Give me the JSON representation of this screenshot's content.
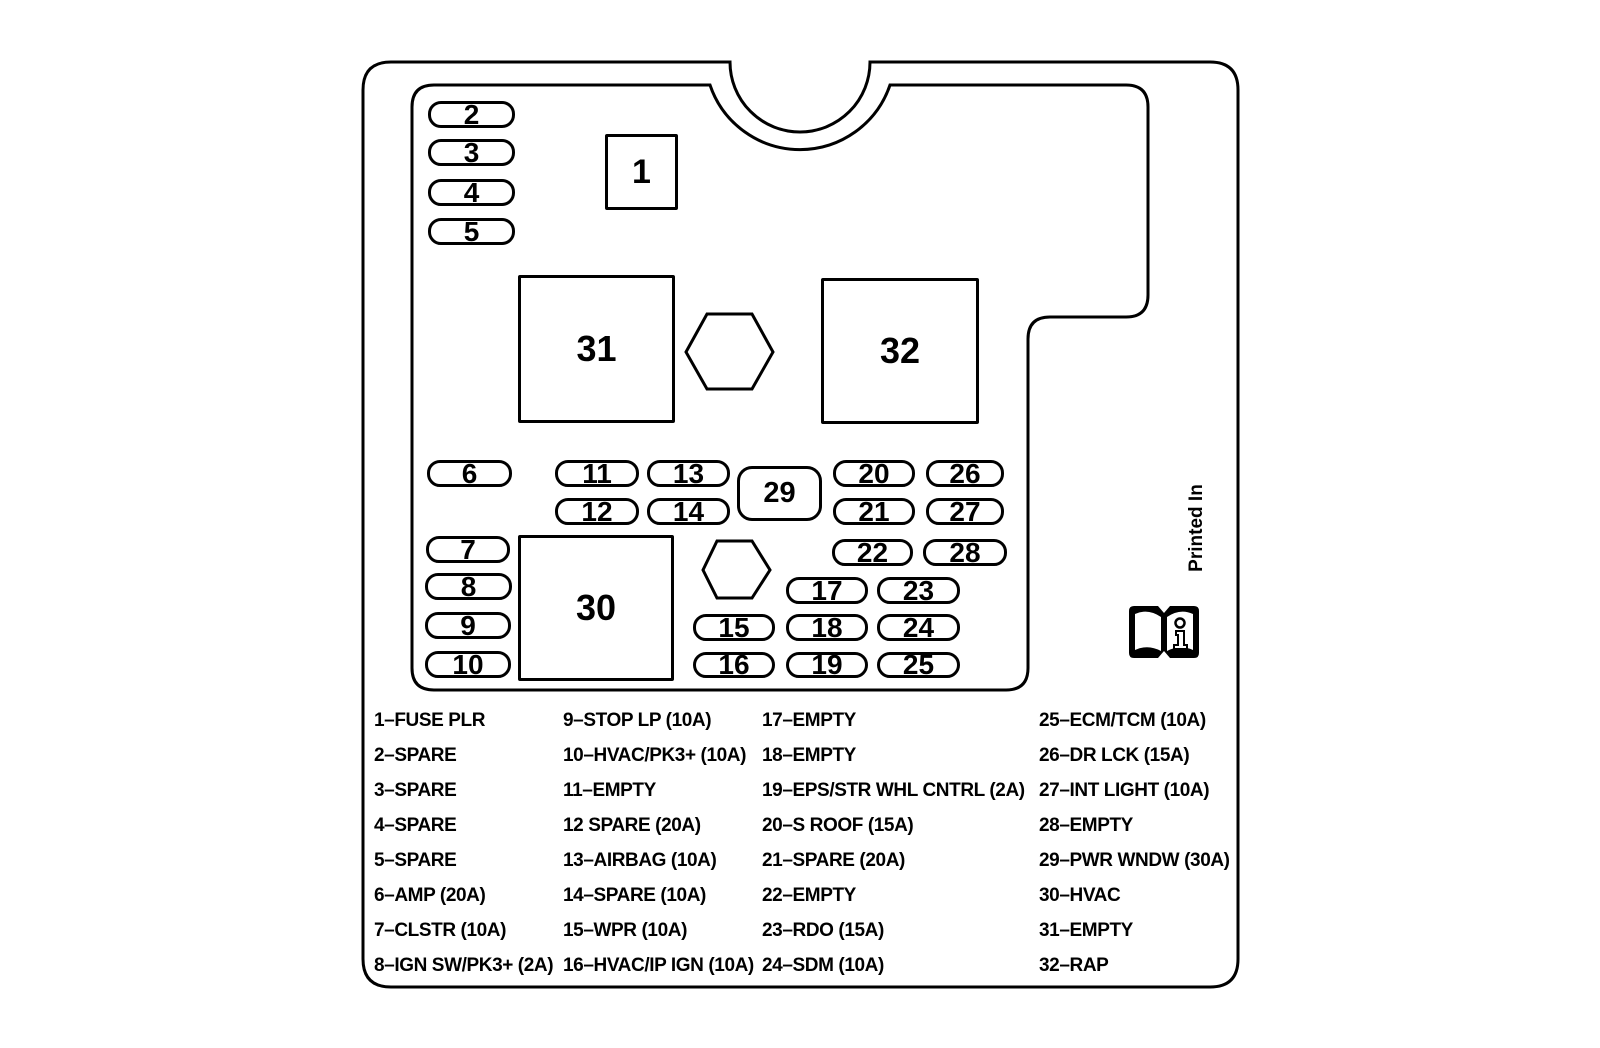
{
  "panel": {
    "printed_in": "Printed In",
    "small_fuses": [
      {
        "label": "2",
        "x": 428,
        "y": 101,
        "w": 87,
        "h": 27
      },
      {
        "label": "3",
        "x": 428,
        "y": 139,
        "w": 87,
        "h": 27
      },
      {
        "label": "4",
        "x": 428,
        "y": 179,
        "w": 87,
        "h": 27
      },
      {
        "label": "5",
        "x": 428,
        "y": 218,
        "w": 87,
        "h": 27
      },
      {
        "label": "6",
        "x": 427,
        "y": 460,
        "w": 85,
        "h": 27
      },
      {
        "label": "7",
        "x": 426,
        "y": 536,
        "w": 84,
        "h": 27
      },
      {
        "label": "8",
        "x": 425,
        "y": 573,
        "w": 87,
        "h": 27
      },
      {
        "label": "9",
        "x": 425,
        "y": 612,
        "w": 86,
        "h": 27
      },
      {
        "label": "10",
        "x": 425,
        "y": 651,
        "w": 86,
        "h": 27
      },
      {
        "label": "11",
        "x": 555,
        "y": 460,
        "w": 84,
        "h": 27
      },
      {
        "label": "12",
        "x": 555,
        "y": 498,
        "w": 84,
        "h": 27
      },
      {
        "label": "13",
        "x": 647,
        "y": 460,
        "w": 83,
        "h": 27
      },
      {
        "label": "14",
        "x": 647,
        "y": 498,
        "w": 83,
        "h": 27
      },
      {
        "label": "15",
        "x": 693,
        "y": 614,
        "w": 82,
        "h": 27
      },
      {
        "label": "16",
        "x": 693,
        "y": 652,
        "w": 82,
        "h": 26
      },
      {
        "label": "17",
        "x": 786,
        "y": 577,
        "w": 82,
        "h": 27
      },
      {
        "label": "18",
        "x": 786,
        "y": 614,
        "w": 82,
        "h": 27
      },
      {
        "label": "19",
        "x": 786,
        "y": 652,
        "w": 82,
        "h": 26
      },
      {
        "label": "20",
        "x": 833,
        "y": 460,
        "w": 82,
        "h": 27
      },
      {
        "label": "21",
        "x": 833,
        "y": 498,
        "w": 82,
        "h": 27
      },
      {
        "label": "22",
        "x": 832,
        "y": 539,
        "w": 81,
        "h": 27
      },
      {
        "label": "23",
        "x": 877,
        "y": 577,
        "w": 83,
        "h": 27
      },
      {
        "label": "24",
        "x": 877,
        "y": 614,
        "w": 83,
        "h": 27
      },
      {
        "label": "25",
        "x": 877,
        "y": 652,
        "w": 83,
        "h": 26
      },
      {
        "label": "26",
        "x": 926,
        "y": 460,
        "w": 78,
        "h": 27
      },
      {
        "label": "27",
        "x": 926,
        "y": 498,
        "w": 78,
        "h": 27
      },
      {
        "label": "28",
        "x": 923,
        "y": 539,
        "w": 84,
        "h": 27
      }
    ],
    "relay": {
      "label": "29",
      "x": 737,
      "y": 466,
      "w": 85,
      "h": 55
    },
    "large_boxes": [
      {
        "label": "1",
        "x": 605,
        "y": 134,
        "w": 73,
        "h": 76,
        "font": 34
      },
      {
        "label": "31",
        "x": 518,
        "y": 275,
        "w": 157,
        "h": 148,
        "font": 36
      },
      {
        "label": "32",
        "x": 821,
        "y": 278,
        "w": 158,
        "h": 146,
        "font": 36
      },
      {
        "label": "30",
        "x": 518,
        "y": 535,
        "w": 156,
        "h": 146,
        "font": 36
      }
    ]
  },
  "legend": {
    "top": 710,
    "step": 35,
    "columns": [
      {
        "x": 374,
        "items": [
          "1–FUSE PLR",
          "2–SPARE",
          "3–SPARE",
          "4–SPARE",
          "5–SPARE",
          "6–AMP (20A)",
          "7–CLSTR (10A)",
          "8–IGN SW/PK3+ (2A)"
        ]
      },
      {
        "x": 563,
        "items": [
          "9–STOP LP (10A)",
          "10–HVAC/PK3+ (10A)",
          "11–EMPTY",
          "12 SPARE (20A)",
          "13–AIRBAG (10A)",
          "14–SPARE (10A)",
          "15–WPR (10A)",
          "16–HVAC/IP IGN (10A)"
        ]
      },
      {
        "x": 762,
        "items": [
          "17–EMPTY",
          "18–EMPTY",
          "19–EPS/STR WHL CNTRL (2A)",
          "20–S ROOF (15A)",
          "21–SPARE (20A)",
          "22–EMPTY",
          "23–RDO (15A)",
          "24–SDM (10A)"
        ]
      },
      {
        "x": 1039,
        "items": [
          "25–ECM/TCM (10A)",
          "26–DR LCK (15A)",
          "27–INT LIGHT (10A)",
          "28–EMPTY",
          "29–PWR WNDW (30A)",
          "30–HVAC",
          "31–EMPTY",
          "32–RAP"
        ]
      }
    ]
  }
}
